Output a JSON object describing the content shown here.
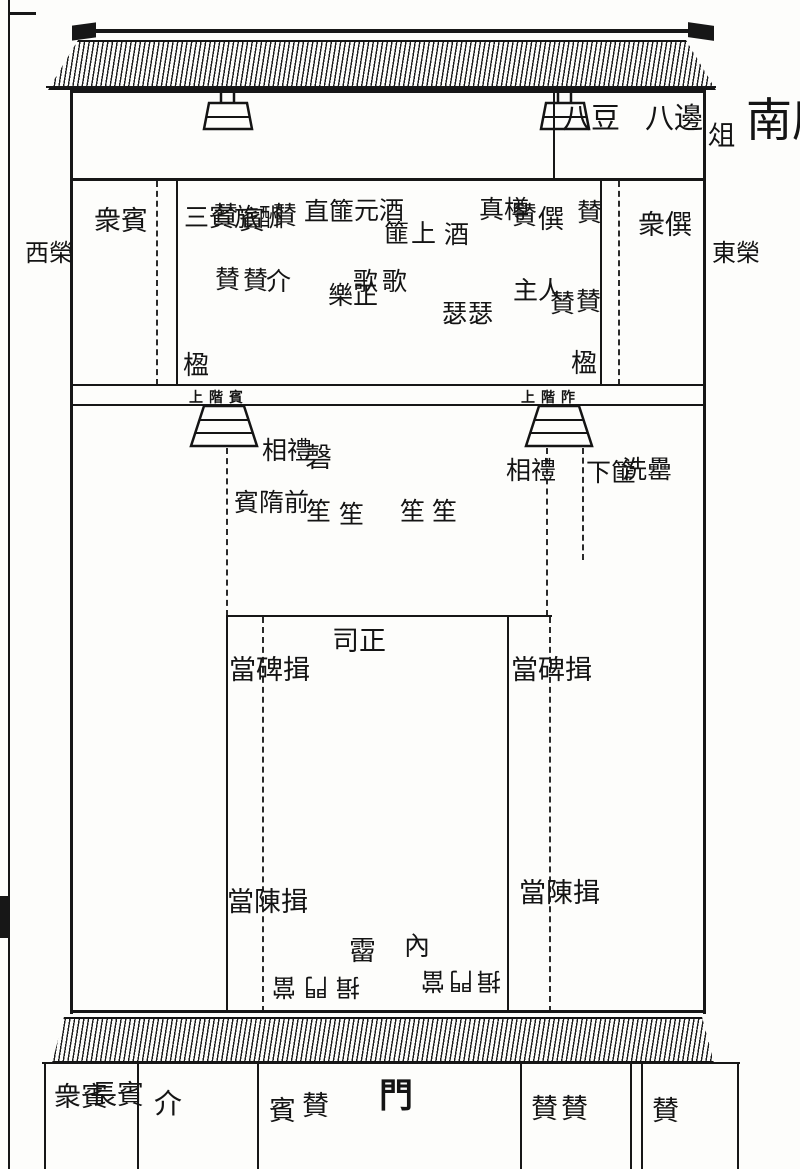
{
  "page": {
    "title": "南康軍學鄉飲圖"
  },
  "margins": {
    "zu_stand": "俎",
    "east_eave": "東榮",
    "west_eave": "西榮"
  },
  "offering_box": {
    "eight_bian": "八邊",
    "eight_dou": "八豆"
  },
  "hall": {
    "west_room_zhong_bin": "衆賓",
    "east_room_zhong_zun": "衆僎",
    "san_bin_lu_chou": "三賓旅酬",
    "pillar_west": "楹",
    "pillar_east": "楹",
    "zan_w1": "賛",
    "bin_guest": "賓",
    "zan_w2": "賛",
    "zan_j1": "賛",
    "zan_j2": "賛",
    "jie": "介",
    "zhi_fei": "直篚",
    "yuan_jiu": "元酒",
    "ge_singers": "歌歌",
    "yue_zheng": "樂正",
    "shang_fei": "篚上",
    "jiu": "酒",
    "zhen_zun": "真樽",
    "se_zithers": "瑟瑟",
    "zan_e1": "賛",
    "zun_honored": "僎",
    "zan_e2": "賛",
    "zhu_ren_host": "主人",
    "zan_h1": "賛",
    "zan_h2": "賛"
  },
  "stairs": {
    "west_guest_steps": "上階賓",
    "east_host_steps": "上階阼"
  },
  "courtyard": {
    "xiang_li_west": "相禮",
    "bin_sui_qian": "賓隋前",
    "qing_chime": "磬",
    "sheng_1": "笙",
    "sheng_2": "笙",
    "sheng_3": "笙",
    "sheng_4": "笙",
    "xiang_li_east": "相禮",
    "xia_fei": "下篚",
    "xi_lei": "洗罍"
  },
  "inner_court": {
    "si_zheng": "司正",
    "bow_at_stele_west": "當碑揖",
    "bow_at_stele_east": "當碑揖",
    "bow_at_chen_west": "當陳揖",
    "bow_at_chen_east": "當陳揖",
    "liu": "霤",
    "nei": "內",
    "bow_at_gate_west_rotated": "揖門當",
    "bow_at_gate_east_rotated": "揖門當"
  },
  "gate_row": {
    "chang_bin": "長賓",
    "zhong_bin": "衆賓",
    "jie": "介",
    "bin": "賓",
    "zan_1": "賛",
    "men_gate": "門",
    "zan_2": "賛",
    "zan_3": "賛",
    "zan_4": "賛"
  }
}
